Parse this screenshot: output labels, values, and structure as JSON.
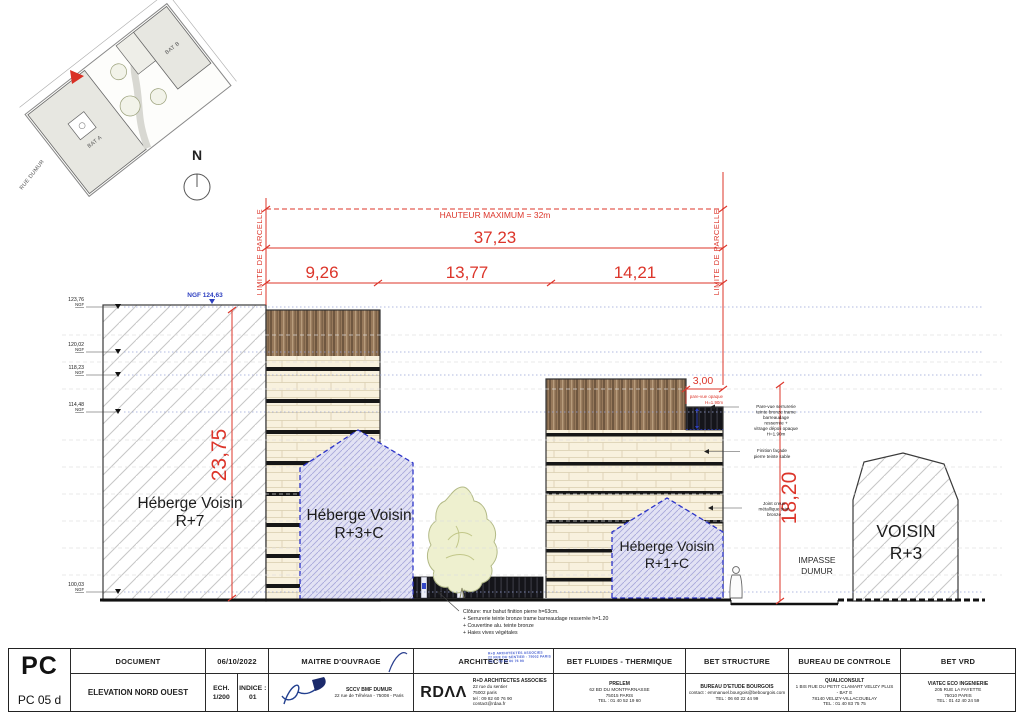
{
  "site_plan": {
    "bat_a": "BAT A",
    "bat_b": "BAT B",
    "street": "RUE DUMUR",
    "north": "N"
  },
  "drawing": {
    "dims": {
      "hauteur_max": "HAUTEUR MAXIMUM = 32m",
      "total": "37,23",
      "segments": [
        "9,26",
        "13,77",
        "14,21"
      ],
      "height_left": "23,75",
      "height_right": "18,20",
      "parevue_width": "3,00",
      "limite": "LIMITE DE PARCELLE",
      "ngf_top": "NGF 124,63",
      "parevue_note": [
        "pare-vue opaque",
        "H=1.90m"
      ]
    },
    "levels": {
      "unit": "NGF",
      "values": [
        "123,76",
        "120,02",
        "118,23",
        "114,48",
        "100,03"
      ]
    },
    "buildings": {
      "heberge_r7": [
        "Héberge Voisin",
        "R+7"
      ],
      "heberge_r3c": [
        "Héberge Voisin",
        "R+3+C"
      ],
      "heberge_r1c": [
        "Héberge Voisin",
        "R+1+C"
      ],
      "voisin_r3": [
        "VOISIN",
        "R+3"
      ],
      "impasse": [
        "IMPASSE",
        "DUMUR"
      ]
    },
    "annotations": {
      "pare_vue": [
        "Pare-vue serrurerie",
        "teinte bronze trame",
        "barreaudage",
        "resserrée +",
        "vitrage dépoli opaque",
        "H=1.90m"
      ],
      "facade": [
        "Finition façade",
        "pierre teinte sable"
      ],
      "joint": [
        "Joint creux",
        "métallique teint",
        "bronze"
      ],
      "cloture": [
        "Clôture: mur bahut finition pierre h=63cm.",
        "+ Serrurerie teinte bronze trame barreaudage resserrée h=1.20",
        "+ Couvertine alu. teinte bronze",
        "+ Haies vives végétales"
      ]
    }
  },
  "titleblock": {
    "code": "PC",
    "sheet": "PC 05 d",
    "document": {
      "header": "DOCUMENT",
      "title": "ELEVATION NORD OUEST"
    },
    "date": "06/10/2022",
    "ech_label": "ECH.",
    "ech_value": "1/200",
    "indice_label": "INDICE :",
    "indice_value": "01",
    "moa": {
      "header": "MAITRE D'OUVRAGE",
      "name": "SCCV BMF DUMUR",
      "address": "22 rue de Téhéran - 75008 - Paris"
    },
    "architecte": {
      "header": "ARCHITECTE",
      "logo": "RDΛΛ",
      "name": "R+D ARCHITECTES ASSOCIES",
      "lines": [
        "22 rue du sentier",
        "75002 paris",
        "tel : 09 82 60 76 90",
        "contact@rdaa.fr"
      ],
      "stamp": [
        "R+D ARCHITECTES ASSOCIES",
        "22 RUE DU SENTIER - 75002 PARIS",
        "TEL : 09 82 60 76 90"
      ]
    },
    "fluides": {
      "header": "BET FLUIDES - THERMIQUE",
      "name": "PRELEM",
      "lines": [
        "62 BD DU MONTPARNASSE",
        "75015 PARIS",
        "TEL : 01 40 52 19 60"
      ]
    },
    "structure": {
      "header": "BET STRUCTURE",
      "name": "BUREAU D'ETUDE BOURGOIS",
      "lines": [
        "contact : emmanuel.bourgois@bebourgois.com",
        "TEL : 06 60 22 44 99"
      ]
    },
    "controle": {
      "header": "BUREAU DE CONTROLE",
      "name": "QUALICONSULT",
      "lines": [
        "1 BIS RUE DU PETIT CLAMART VELIZY PLUS",
        "- BAT E",
        "78140 VELIZY-VILLACOUBLAY",
        "TEL : 01 40 83 75 75"
      ]
    },
    "vrd": {
      "header": "BET VRD",
      "name": "VIATEC ECO INGENIERIE",
      "lines": [
        "205 RUE LA FAYETTE",
        "75010 PARIS",
        "TEL : 01 42 40 24 59"
      ]
    }
  }
}
